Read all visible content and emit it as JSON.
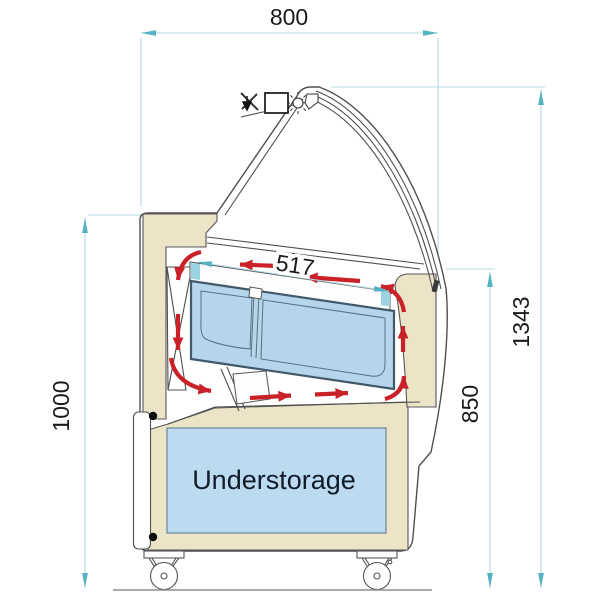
{
  "diagram": {
    "kind": "technical cross-section drawing of a curved-glass serve-over display counter",
    "dimensions": {
      "width": {
        "label": "800",
        "orientation": "horizontal",
        "position": "top"
      },
      "overall_height": {
        "label": "1343",
        "orientation": "vertical",
        "position": "right-outer"
      },
      "body_height": {
        "label": "1000",
        "orientation": "vertical",
        "position": "left"
      },
      "front_height": {
        "label": "850",
        "orientation": "vertical",
        "position": "right-inner"
      },
      "pan_shelf_depth": {
        "label": "517",
        "orientation": "slanted",
        "position": "inside-top"
      }
    },
    "labels": {
      "understorage": "Understorage"
    },
    "colors": {
      "dimension_line": "#b3d9e1",
      "dimension_arrow": "#54b3c3",
      "airflow_arrow": "#c92127",
      "insulation_fill": "#ece4c7",
      "storage_fill": "#bcdaf0",
      "pan_fill": "#b4d5eb",
      "pan_edge": "#42596a",
      "outline": "#4f4f4f",
      "ground": "#8d8d8d",
      "text": "#1b1b1b"
    }
  }
}
